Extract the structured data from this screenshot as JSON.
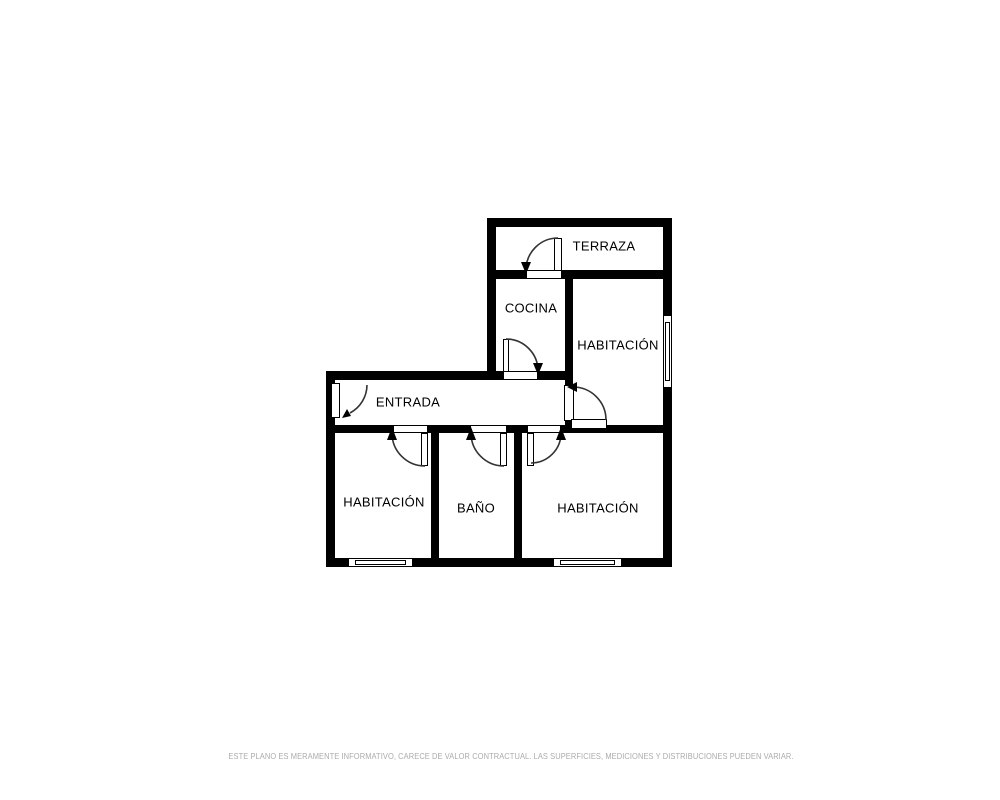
{
  "rooms": {
    "terraza": {
      "label": "TERRAZA"
    },
    "cocina": {
      "label": "COCINA"
    },
    "habitacion_top_right": {
      "label": "HABITACIÓN"
    },
    "entrada": {
      "label": "ENTRADA"
    },
    "habitacion_bottom_left": {
      "label": "HABITACIÓN"
    },
    "bano": {
      "label": "BAÑO"
    },
    "habitacion_bottom_right": {
      "label": "HABITACIÓN"
    }
  },
  "symbols": {
    "doors": [
      "terraza-door",
      "cocina-door",
      "entrance-door",
      "habitacion-top-right-door",
      "habitacion-bottom-left-door",
      "bano-door",
      "habitacion-bottom-right-door"
    ],
    "windows": [
      "habitacion-top-right-window",
      "habitacion-bottom-left-window",
      "habitacion-bottom-right-window"
    ]
  },
  "footer": {
    "disclaimer": "ESTE PLANO ES MERAMENTE INFORMATIVO, CARECE DE VALOR CONTRACTUAL. LAS SUPERFICIES, MEDICIONES Y DISTRIBUCIONES PUEDEN VARIAR."
  },
  "colors": {
    "wall": "#000000",
    "background": "#ffffff",
    "door_arc": "#333333",
    "label_text": "#000000",
    "disclaimer_text": "#ababab"
  }
}
